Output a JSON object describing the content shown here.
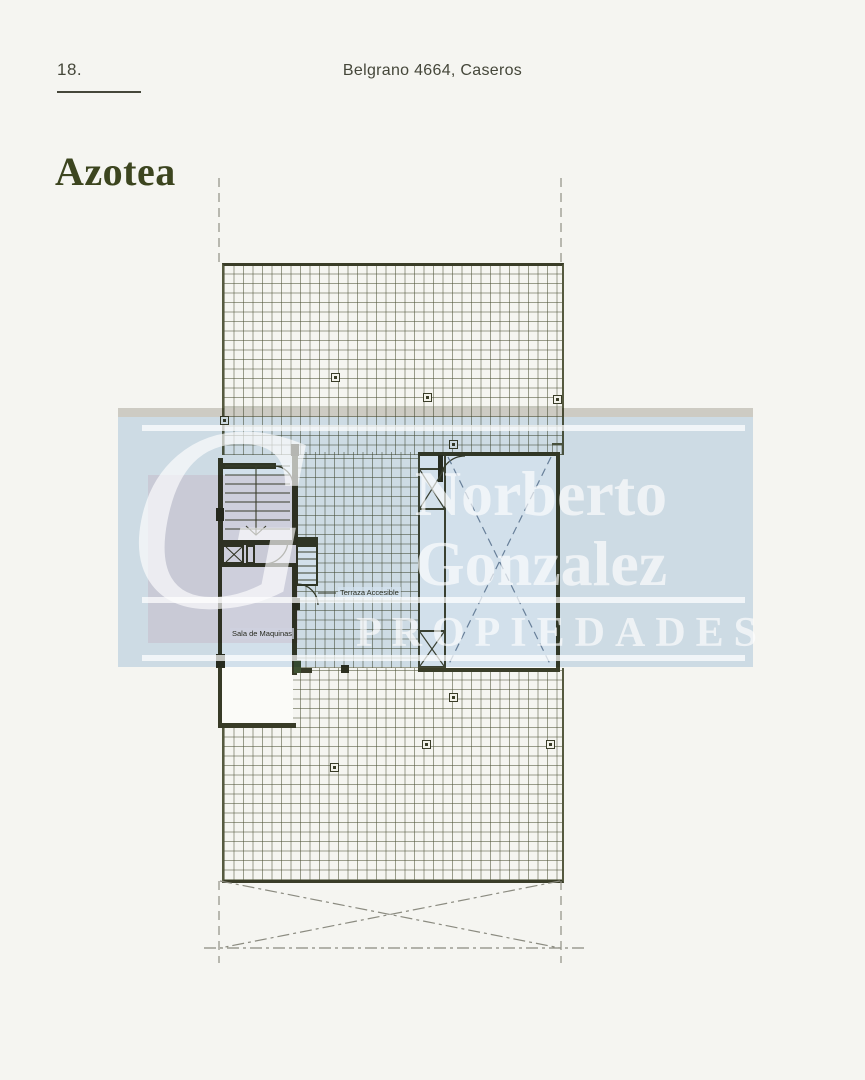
{
  "page": {
    "number": "18.",
    "address": "Belgrano 4664, Caseros",
    "title": "Azotea"
  },
  "plan": {
    "labels": {
      "terrace": "Terraza Accesible",
      "machine_room": "Sala de Maquinas"
    }
  },
  "watermark": {
    "monogram": "G",
    "name_line1": "Norberto",
    "name_line2": "Gonzalez",
    "subtitle": "PROPIEDADES",
    "band_color": "#d6e4f2",
    "square_color": "#d2d3e3",
    "strip_color": "#d6d4cf",
    "text_color": "#ffffff"
  },
  "colors": {
    "page_background": "#f5f5f1",
    "plan_line": "#3a3d28",
    "accent_title": "#3c451f"
  }
}
